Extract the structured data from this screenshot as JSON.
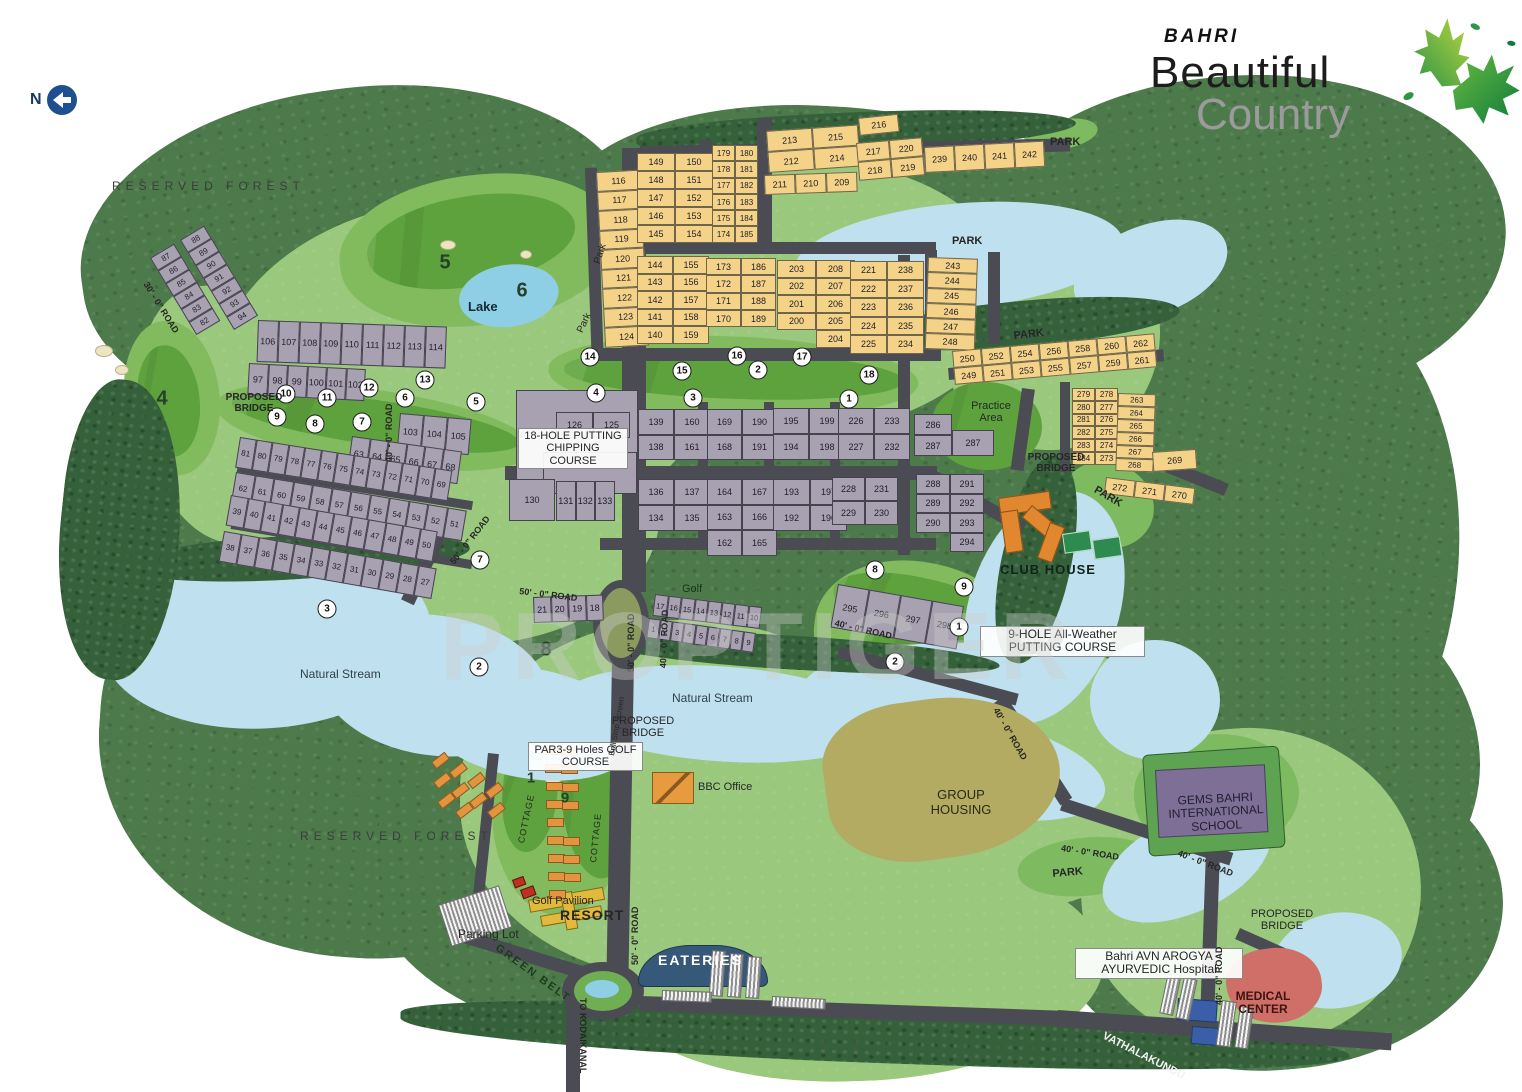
{
  "meta": {
    "north": "N"
  },
  "logo": {
    "brand": "BAHRI",
    "line1": "Beautiful",
    "line2": "Country"
  },
  "watermark": "PROPTIGER",
  "labels": {
    "reserved_forest": "RESERVED FOREST",
    "lake": "Lake",
    "park_caps": "PARK",
    "park_mixed": "Park",
    "natural_stream": "Natural Stream",
    "proposed_bridge": "PROPOSED BRIDGE",
    "chipping": "18-HOLE PUTTING CHIPPING COURSE",
    "club_house": "CLUB HOUSE",
    "practice_area": "Practice Area",
    "putting9": "9-HOLE All-Weather PUTTING COURSE",
    "par3": "PAR3-9 Holes GOLF COURSE",
    "bbc": "BBC Office",
    "group_housing": "GROUP HOUSING",
    "school": "GEMS BAHRI INTERNATIONAL SCHOOL",
    "hospital": "Bahri AVN AROGYA AYURVEDIC Hospital",
    "medical": "MEDICAL CENTER",
    "golf_pavilion": "Golf Pavilion",
    "resort": "RESORT",
    "parking_lot": "Parking Lot",
    "eateries": "EATERIES",
    "green_belt": "GREEN BELT",
    "golf": "Golf",
    "ball_stop": "Ball Stop Screen",
    "cottage": "COTTAGE",
    "road50": "50' - 0\" ROAD",
    "road40": "40' - 0\" ROAD",
    "road30": "30' - 0\" ROAD",
    "to_kodaikanal": "TO KODAIKANAL",
    "vathalakundu": "VATHALAKUNDU"
  },
  "plots": {
    "g116": {
      "type": "yellow",
      "cells": [
        "116",
        "117",
        "118",
        "119",
        "120",
        "121",
        "122",
        "123",
        "124"
      ]
    },
    "g145": {
      "type": "yellow",
      "cells": [
        "149",
        "150",
        "148",
        "151",
        "147",
        "152",
        "146",
        "153",
        "145",
        "154"
      ]
    },
    "g174": {
      "type": "yellow",
      "cells": [
        "179",
        "180",
        "178",
        "181",
        "177",
        "182",
        "176",
        "183",
        "175",
        "184",
        "174",
        "185"
      ]
    },
    "g211a": {
      "type": "yellow",
      "cells": [
        "213",
        "215",
        "212",
        "214"
      ]
    },
    "g211b": {
      "type": "yellow",
      "cells": [
        "211",
        "210",
        "209"
      ]
    },
    "g216a": {
      "type": "yellow",
      "cells": [
        "216"
      ]
    },
    "g216b": {
      "type": "yellow",
      "cells": [
        "217",
        "220",
        "218",
        "219"
      ]
    },
    "g239": {
      "type": "yellow",
      "cells": [
        "239",
        "240",
        "241",
        "242"
      ]
    },
    "g140": {
      "type": "yellow",
      "cells": [
        "144",
        "155",
        "143",
        "156",
        "142",
        "157",
        "141",
        "158",
        "140",
        "159"
      ]
    },
    "g170": {
      "type": "yellow",
      "cells": [
        "173",
        "186",
        "172",
        "187",
        "171",
        "188",
        "170",
        "189"
      ]
    },
    "g200": {
      "type": "yellow",
      "cells": [
        "203",
        "208",
        "202",
        "207",
        "201",
        "206",
        "200",
        "205",
        "",
        "204"
      ]
    },
    "g221": {
      "type": "yellow",
      "cells": [
        "221",
        "238",
        "222",
        "237",
        "223",
        "236",
        "224",
        "235",
        "225",
        "234"
      ]
    },
    "g243": {
      "type": "yellow",
      "cells": [
        "243",
        "244",
        "245",
        "246",
        "247",
        "248"
      ]
    },
    "g249": {
      "type": "yellow",
      "cells": [
        "250",
        "252",
        "254",
        "256",
        "258",
        "260",
        "262",
        "249",
        "251",
        "253",
        "255",
        "257",
        "259",
        "261"
      ]
    },
    "g273": {
      "type": "yellow",
      "cells": [
        "279",
        "278",
        "280",
        "277",
        "281",
        "276",
        "282",
        "275",
        "283",
        "274",
        "284",
        "273"
      ]
    },
    "g263": {
      "type": "yellow",
      "cells": [
        "263",
        "264",
        "265",
        "266",
        "267",
        "268"
      ]
    },
    "g269": {
      "type": "yellow",
      "cells": [
        "269"
      ]
    },
    "g270": {
      "type": "yellow",
      "cells": [
        "272",
        "271",
        "270"
      ]
    },
    "h82": {
      "type": "gray",
      "cells": [
        "87",
        "88",
        "86",
        "89",
        "85",
        "90",
        "84",
        "91",
        "83",
        "92",
        "82",
        "93",
        "",
        "94"
      ]
    },
    "h106": {
      "type": "gray",
      "cells": [
        "106",
        "107",
        "108",
        "109",
        "110",
        "111",
        "112",
        "113",
        "114"
      ]
    },
    "h97": {
      "type": "gray",
      "cells": [
        "97",
        "98",
        "99",
        "100",
        "101",
        "102"
      ]
    },
    "h103": {
      "type": "gray",
      "cells": [
        "103",
        "104",
        "105"
      ]
    },
    "h63": {
      "type": "gray",
      "cells": [
        "63",
        "64",
        "65",
        "66",
        "67",
        "68"
      ]
    },
    "h69": {
      "type": "gray",
      "cells": [
        "81",
        "80",
        "79",
        "78",
        "77",
        "76",
        "75",
        "74",
        "73",
        "72",
        "71",
        "70",
        "69"
      ]
    },
    "h51": {
      "type": "gray",
      "cells": [
        "62",
        "61",
        "60",
        "59",
        "58",
        "57",
        "56",
        "55",
        "54",
        "53",
        "52",
        "51"
      ]
    },
    "h39": {
      "type": "gray",
      "cells": [
        "39",
        "40",
        "41",
        "42",
        "43",
        "44",
        "45",
        "46",
        "47",
        "48",
        "49",
        "50"
      ]
    },
    "h27": {
      "type": "gray",
      "cells": [
        "38",
        "37",
        "36",
        "35",
        "34",
        "33",
        "32",
        "31",
        "30",
        "29",
        "28",
        "27"
      ]
    },
    "h125": {
      "type": "gray",
      "cells": [
        "126",
        "125"
      ]
    },
    "h130": {
      "type": "gray",
      "cells": [
        "130"
      ]
    },
    "h131": {
      "type": "gray",
      "cells": [
        "131",
        "132",
        "133"
      ]
    },
    "h134": {
      "type": "gray",
      "cells": [
        "136",
        "137",
        "134",
        "135"
      ]
    },
    "h162": {
      "type": "gray",
      "cells": [
        "164",
        "167",
        "163",
        "166",
        "162",
        "165"
      ]
    },
    "h192": {
      "type": "gray",
      "cells": [
        "193",
        "197",
        "192",
        "196"
      ]
    },
    "h138": {
      "type": "gray",
      "cells": [
        "139",
        "160",
        "138",
        "161"
      ]
    },
    "h168": {
      "type": "gray",
      "cells": [
        "169",
        "190",
        "168",
        "191"
      ]
    },
    "h194": {
      "type": "gray",
      "cells": [
        "195",
        "199",
        "194",
        "198"
      ]
    },
    "h226": {
      "type": "gray",
      "cells": [
        "226",
        "233",
        "227",
        "232"
      ]
    },
    "h228": {
      "type": "gray",
      "cells": [
        "228",
        "231",
        "229",
        "230"
      ]
    },
    "h286": {
      "type": "gray",
      "cells": [
        "286",
        "287"
      ]
    },
    "h287": {
      "type": "gray",
      "cells": [
        "287"
      ]
    },
    "h288": {
      "type": "gray",
      "cells": [
        "288",
        "291",
        "289",
        "292",
        "290",
        "293",
        "",
        "294"
      ]
    },
    "h18": {
      "type": "gray",
      "cells": [
        "21",
        "20",
        "19",
        "18"
      ]
    },
    "h10": {
      "type": "gray",
      "cells": [
        "17",
        "16",
        "15",
        "14",
        "13",
        "12",
        "11",
        "10"
      ]
    },
    "h1": {
      "type": "gray",
      "cells": [
        "1",
        "2",
        "3",
        "4",
        "5",
        "6",
        "7",
        "8",
        "9"
      ]
    },
    "h295": {
      "type": "gray",
      "cells": [
        "295",
        "296",
        "297",
        "298"
      ]
    }
  },
  "golf_holes": [
    {
      "n": "9",
      "x": 277,
      "y": 417
    },
    {
      "n": "10",
      "x": 286,
      "y": 394
    },
    {
      "n": "11",
      "x": 327,
      "y": 398
    },
    {
      "n": "12",
      "x": 369,
      "y": 388
    },
    {
      "n": "13",
      "x": 425,
      "y": 380
    },
    {
      "n": "6",
      "x": 405,
      "y": 398
    },
    {
      "n": "5",
      "x": 476,
      "y": 402
    },
    {
      "n": "8",
      "x": 315,
      "y": 424
    },
    {
      "n": "7",
      "x": 362,
      "y": 422
    },
    {
      "n": "3",
      "x": 327,
      "y": 609
    },
    {
      "n": "2",
      "x": 479,
      "y": 667
    },
    {
      "n": "7",
      "x": 480,
      "y": 560
    },
    {
      "n": "14",
      "x": 590,
      "y": 357
    },
    {
      "n": "4",
      "x": 596,
      "y": 393
    },
    {
      "n": "15",
      "x": 682,
      "y": 371
    },
    {
      "n": "3",
      "x": 693,
      "y": 398
    },
    {
      "n": "16",
      "x": 737,
      "y": 356
    },
    {
      "n": "2",
      "x": 758,
      "y": 370
    },
    {
      "n": "17",
      "x": 802,
      "y": 357
    },
    {
      "n": "18",
      "x": 869,
      "y": 375
    },
    {
      "n": "1",
      "x": 849,
      "y": 399
    },
    {
      "n": "8",
      "x": 875,
      "y": 570
    },
    {
      "n": "9",
      "x": 964,
      "y": 587
    },
    {
      "n": "1",
      "x": 959,
      "y": 627
    },
    {
      "n": "2",
      "x": 895,
      "y": 662
    }
  ],
  "course_numbers": [
    {
      "n": "4",
      "x": 162,
      "y": 399,
      "s": 20
    },
    {
      "n": "5",
      "x": 445,
      "y": 263,
      "s": 20
    },
    {
      "n": "6",
      "x": 522,
      "y": 291,
      "s": 20
    },
    {
      "n": "8",
      "x": 546,
      "y": 650,
      "s": 20
    },
    {
      "n": "1",
      "x": 531,
      "y": 778,
      "s": 15
    },
    {
      "n": "9",
      "x": 565,
      "y": 798,
      "s": 15
    }
  ],
  "decor": {
    "cottages": [
      [
        432,
        756,
        -38
      ],
      [
        450,
        766,
        -38
      ],
      [
        468,
        776,
        -38
      ],
      [
        486,
        786,
        -38
      ],
      [
        434,
        776,
        -38
      ],
      [
        452,
        786,
        -38
      ],
      [
        470,
        796,
        -38
      ],
      [
        488,
        806,
        -38
      ],
      [
        438,
        796,
        -38
      ],
      [
        456,
        806,
        -38
      ],
      [
        545,
        746,
        0
      ],
      [
        545,
        764,
        0
      ],
      [
        546,
        782,
        0
      ],
      [
        546,
        800,
        0
      ],
      [
        547,
        818,
        0
      ],
      [
        547,
        836,
        0
      ],
      [
        548,
        854,
        0
      ],
      [
        548,
        872,
        0
      ],
      [
        549,
        890,
        0
      ],
      [
        561,
        747,
        0
      ],
      [
        561,
        765,
        0
      ],
      [
        562,
        783,
        0
      ],
      [
        562,
        801,
        0
      ],
      [
        563,
        837,
        0
      ],
      [
        563,
        855,
        0
      ],
      [
        564,
        873,
        0
      ]
    ]
  },
  "colors": {
    "forest": "#4d7a4b",
    "site_green": "#9ac87c",
    "fairway": "#5da23d",
    "water": "#bfe0ee",
    "road": "#4b4b53",
    "plot_yellow": "#f4d389",
    "plot_gray": "#a7a1b1",
    "clubhouse": "#e0872f",
    "group_housing": "#b3ab62",
    "medical": "#cf6f68",
    "logo_green": "#2f9447"
  }
}
